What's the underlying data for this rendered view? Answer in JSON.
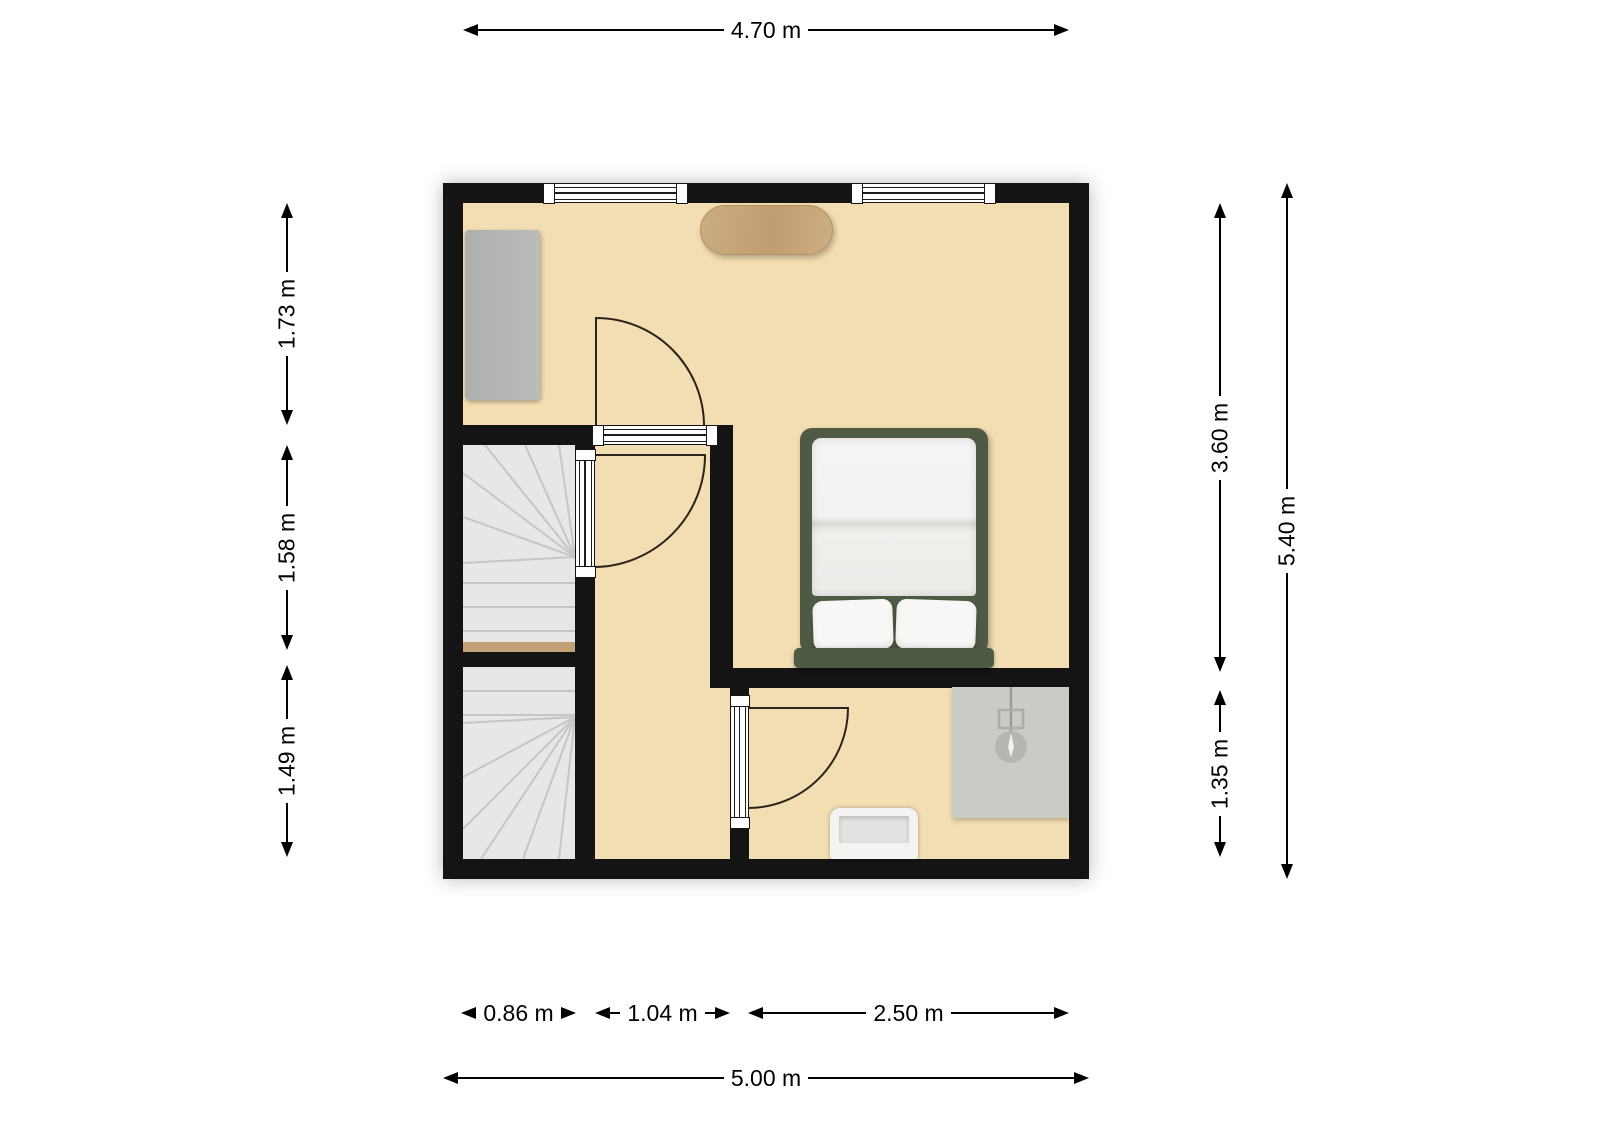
{
  "dimensions": {
    "unit": "m",
    "top": {
      "label": "4.70 m"
    },
    "left": [
      {
        "label": "1.73 m"
      },
      {
        "label": "1.58 m"
      },
      {
        "label": "1.49 m"
      }
    ],
    "right_inner": [
      {
        "label": "3.60 m"
      },
      {
        "label": "1.35 m"
      }
    ],
    "right_outer": {
      "label": "5.40 m"
    },
    "bottom_inner": [
      {
        "label": "0.86 m"
      },
      {
        "label": "1.04 m"
      },
      {
        "label": "2.50 m"
      }
    ],
    "bottom_outer": {
      "label": "5.00 m"
    }
  },
  "furniture": [
    "dresser",
    "wooden-table",
    "double-bed",
    "shower",
    "sink",
    "winder-stairs-upper",
    "winder-stairs-lower"
  ],
  "openings": [
    "window-1",
    "window-2",
    "glazed-door-room",
    "glazed-door-stairs",
    "glazed-door-bathroom"
  ],
  "colors": {
    "wall": "#141414",
    "floor": "#f3ddb2",
    "stair": "#e7e7e6",
    "stair-line": "#c6c6c6",
    "threshold": "#c2a176",
    "glazing": "#ffffff",
    "bed-frame": "#4e5a44",
    "bedding": "#f1f1ef",
    "shower": "#c9cbc7",
    "shower-dark": "#b4b7b2",
    "wood": "#c8a87f",
    "dim-line": "#000000"
  }
}
